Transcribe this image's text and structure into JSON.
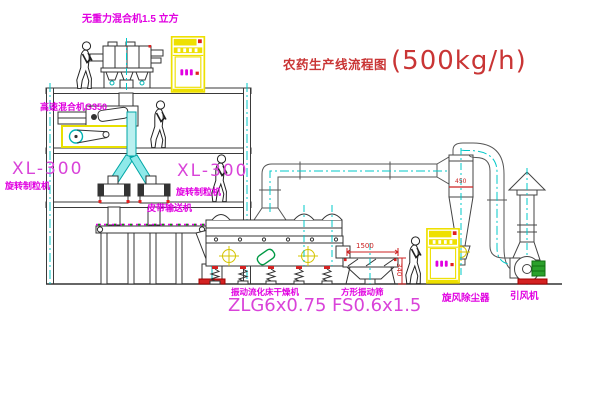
{
  "title": {
    "text_cn": "农药生产线流程图",
    "capacity": "(500kg/h)"
  },
  "labels": {
    "gravity_mixer": "无重力混合机1.5 立方",
    "high_speed_mixer": "高速混合机G350",
    "granulator_left_model": "XL-300",
    "granulator_left_name": "旋转制粒机",
    "granulator_right_model": "XL-300",
    "granulator_right_name": "旋转制粒机",
    "belt_conveyor": "皮带输送机",
    "dryer_name": "振动流化床干燥机",
    "dryer_model": "ZLG6x0.75",
    "sieve_name": "方形振动筛",
    "sieve_model": "FS0.6x1.5",
    "cyclone_name": "旋风除尘器",
    "fan_name": "引风机"
  },
  "dimensions": {
    "sieve_length": "1500",
    "sieve_outlet_height": "340",
    "cyclone_dim": "450"
  },
  "colors": {
    "label_magenta": "#e100e1",
    "model_magenta": "#d943d9",
    "title_red": "#c93535",
    "dimension_red": "#cc2222",
    "centerline_cyan": "#00c8c8",
    "cabinet_yellow": "#eee000",
    "motor_green": "#2ba02b"
  }
}
